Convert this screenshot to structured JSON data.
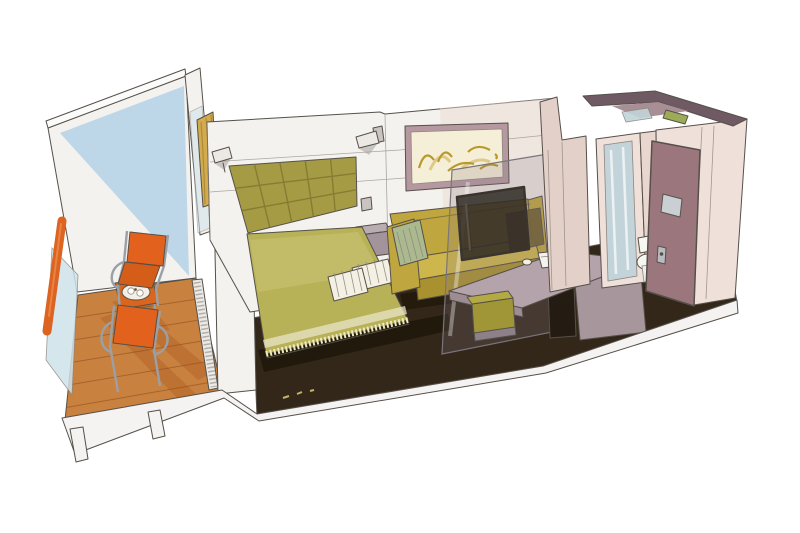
{
  "meta": {
    "title": "Cruise ship balcony cabin - watercolor cutaway illustration",
    "type": "architectural interior rendering, isometric cutaway, no text",
    "background": "#ffffff"
  },
  "scene": {
    "areas": [
      "balcony",
      "bedroom",
      "living-area",
      "desk-corner",
      "bathroom",
      "entry"
    ],
    "objects": [
      "balcony deck of wood planks",
      "glass balcony railing with orange handrail",
      "two orange lounge chairs",
      "orange bistro table with coffee tray and cups",
      "sliding glass door with gold curtain",
      "double bed with olive-green bedspread and fringe",
      "olive tufted headboard",
      "two wall-mounted reading lamps",
      "two folded white towels on bed",
      "grey nightstand and light switch",
      "framed abstract gold-stroke artwork",
      "mustard-yellow sofa with sage striped throw and dark cushion",
      "glass room divider with mounted TV",
      "grey-mauve writing desk with notebook and cup",
      "olive cube stool",
      "corridor wardrobe wall",
      "bathroom doorway with shower glass",
      "white toilet",
      "open mauve cabin door with frosted window",
      "dark brown carpet",
      "white hull base with support legs"
    ]
  },
  "colors": {
    "ink": "#56504a",
    "paper": "#ffffff",
    "wall_white": "#f4f2ef",
    "wall_shade": "#e6e2dc",
    "ceiling_band": "#fbfbfa",
    "wall_pink_wash": "#ead9d2",
    "balcony_wall_blue": "#b9d5e7",
    "deck_wood": "#c8813e",
    "deck_plank": "#9e5c28",
    "deck_shadow": "#a34a14",
    "track_gray": "#eceae6",
    "hatch_gray": "#9a968f",
    "railing_orange": "#dd6320",
    "railing_glass": "#cfe2ea",
    "chair_orange": "#e2621d",
    "chair_seat": "#d55d1a",
    "chair_frame": "#9aa0a6",
    "table_orange": "#d9661c",
    "tray_white": "#f3efe6",
    "curtain_gold": "#d2ab4e",
    "curtain_fold": "#a8842f",
    "headboard_olive": "#a59b44",
    "headboard_line": "#7f742e",
    "bed_olive": "#b7b157",
    "bed_light": "#d6d189",
    "bed_sheet": "#e9e6c8",
    "fringe_cream": "#efe9c0",
    "pillow_white": "#f4f1e4",
    "pillow_line": "#cfc9b4",
    "sofa_mustard": "#c0a63e",
    "sofa_light": "#cdb64c",
    "sofa_dark": "#a9912f",
    "throw_sage": "#abb98e",
    "throw_line": "#8fa070",
    "cushion_dark": "#6e6030",
    "glass_tint": "rgba(135,125,130,0.22)",
    "glass_edge": "#7a757a",
    "tv_dark": "rgba(48,42,36,0.85)",
    "frame_mauve": "#b598a0",
    "frame_mat": "#f6efd7",
    "art_gold": "#b9992c",
    "art_gold_light": "#d7c276",
    "desk_top": "#b4a3aa",
    "desk_front": "#9d8c93",
    "desk_side": "#a8969d",
    "desk_opening": "#241b12",
    "stool_olive": "#b3a945",
    "stool_front": "#a09637",
    "stool_base": "#8d8088",
    "notebook_white": "#f3f2ee",
    "nightstand_top": "#b9adb2",
    "nightstand_front": "#a2949a",
    "nightstand_side": "#8d7f85",
    "lamp_white": "#ece9e5",
    "lamp_shadow": "#8b8681",
    "switch_gray": "#c9c4bf",
    "carpet_brown": "#33271a",
    "carpet_shadow": "#1f1709",
    "column_pink": "#e3d0c9",
    "bath_front_pink": "#efe0da",
    "bath_wall_mid": "#e8d6cf",
    "bath_top_dark": "#6f5a63",
    "bath_inner_mauve": "#a88f96",
    "shower_glass": "#c2d4da",
    "door_mauve": "#9b777d",
    "door_window": "#ccd4d8",
    "door_handle": "#b9bcbe",
    "toilet_white": "#f6f6f3",
    "towel_green": "#9cab57",
    "plinth_white": "#f4f3f2",
    "accent_yellow": "#e8d77a"
  }
}
